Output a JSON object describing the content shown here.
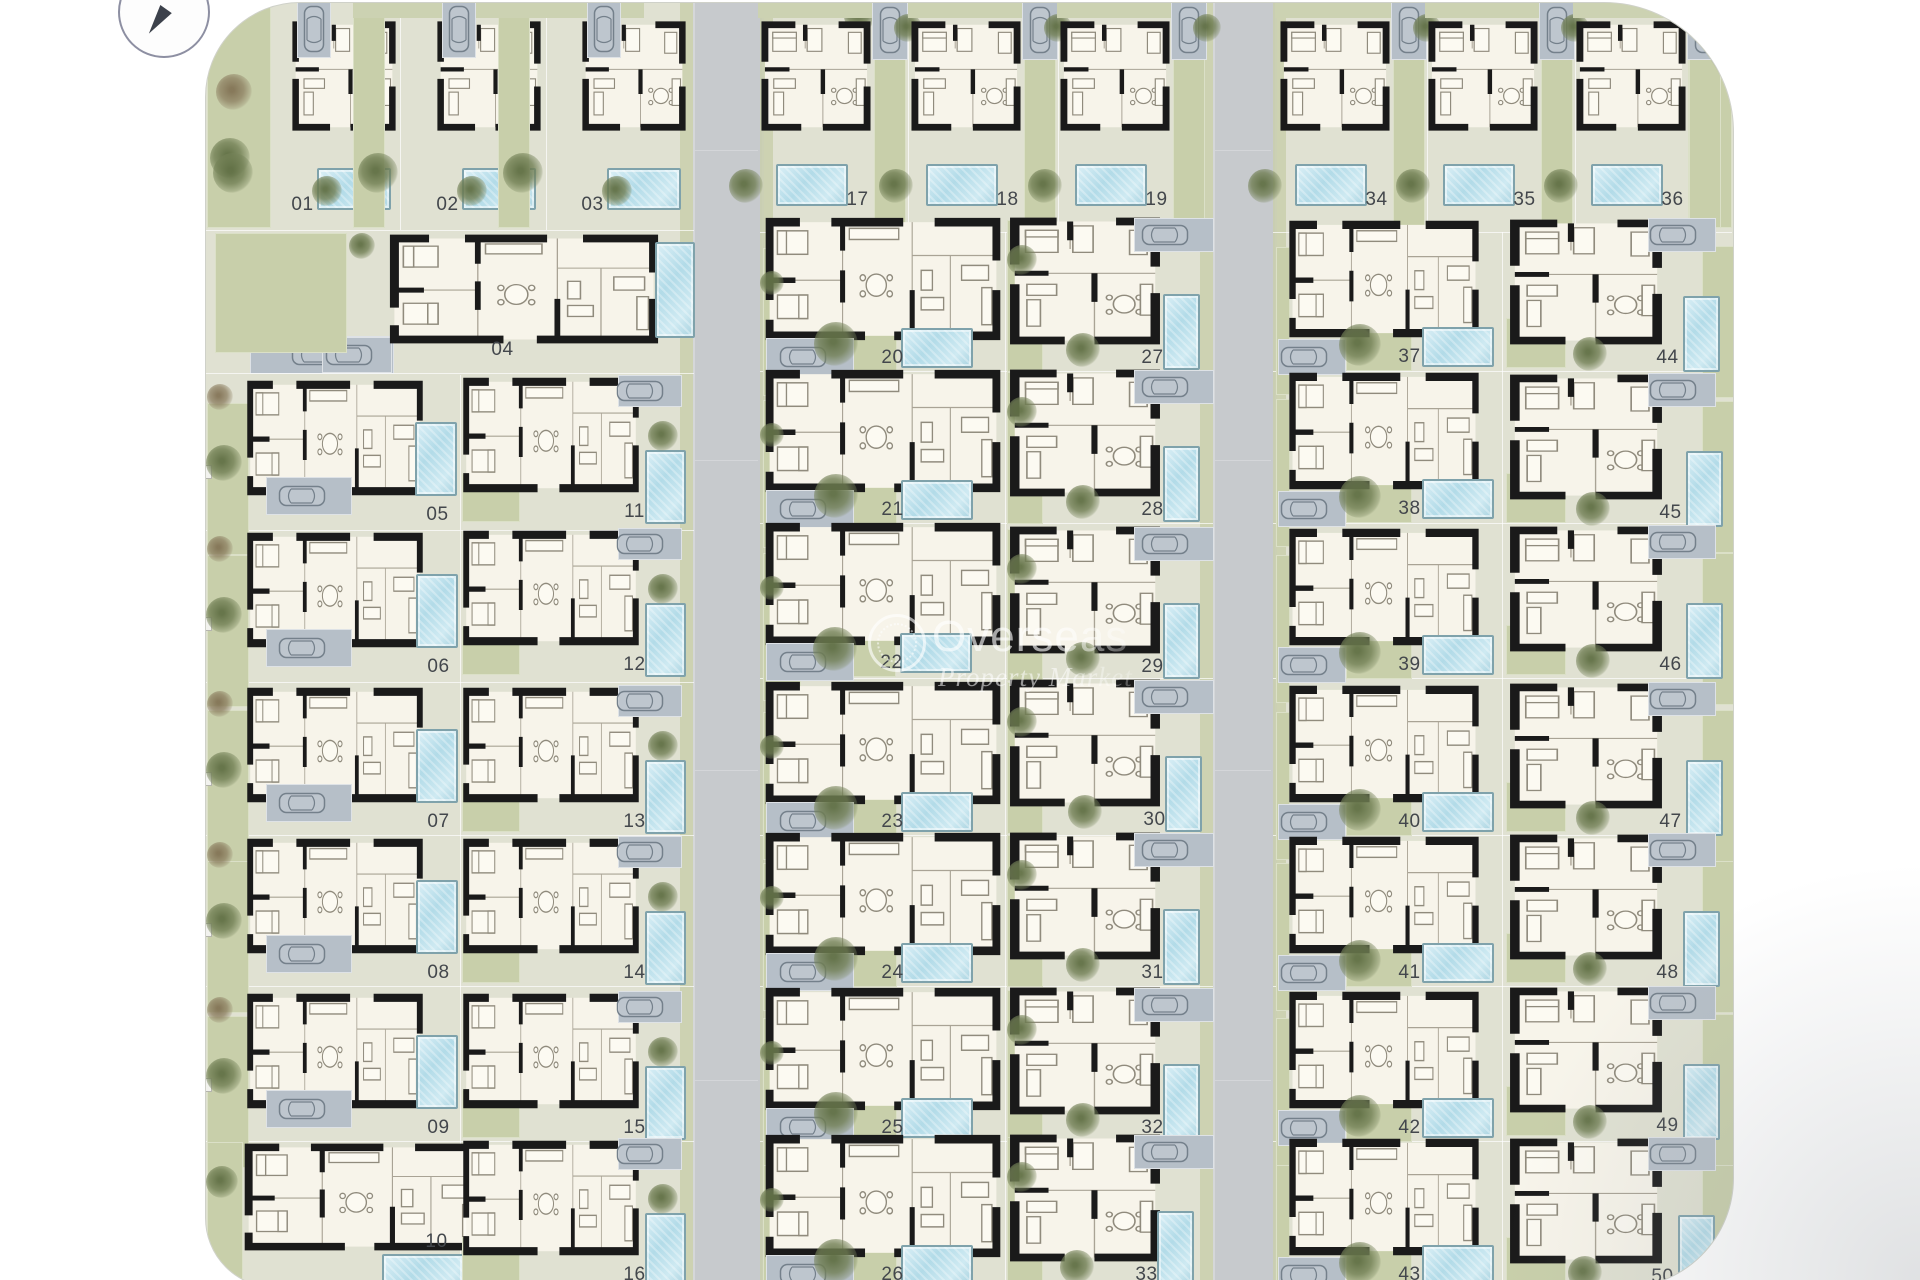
{
  "watermark": {
    "brand": "Overseas",
    "tagline": "Property Market"
  },
  "compass": {
    "icon": "north-arrow"
  },
  "palette": {
    "ground": "#e0e1d2",
    "garden": "#c8cfaa",
    "road": "#c7cacd",
    "parking": "#b6bfc8",
    "pool_water": "#b2dbe8",
    "walls": "#1a1a1a",
    "label_text": "#43474c"
  },
  "plots": [
    {
      "n": "01",
      "kind": "topL",
      "lx": 303,
      "ly": 205
    },
    {
      "n": "02",
      "kind": "topL",
      "lx": 448,
      "ly": 205
    },
    {
      "n": "03",
      "kind": "topL",
      "lx": 593,
      "ly": 205
    },
    {
      "n": "04",
      "kind": "U04",
      "lx": 503,
      "ly": 350
    },
    {
      "n": "05",
      "kind": "LA",
      "lx": 438,
      "ly": 515
    },
    {
      "n": "06",
      "kind": "LA",
      "lx": 439,
      "ly": 667
    },
    {
      "n": "07",
      "kind": "LA",
      "lx": 439,
      "ly": 822
    },
    {
      "n": "08",
      "kind": "LA",
      "lx": 439,
      "ly": 973
    },
    {
      "n": "09",
      "kind": "LA",
      "lx": 439,
      "ly": 1128
    },
    {
      "n": "10",
      "kind": "L10",
      "lx": 437,
      "ly": 1242
    },
    {
      "n": "11",
      "kind": "LB",
      "lx": 635,
      "ly": 512
    },
    {
      "n": "12",
      "kind": "LB",
      "lx": 635,
      "ly": 665
    },
    {
      "n": "13",
      "kind": "LB",
      "lx": 635,
      "ly": 822
    },
    {
      "n": "14",
      "kind": "LB",
      "lx": 635,
      "ly": 973
    },
    {
      "n": "15",
      "kind": "LB",
      "lx": 635,
      "ly": 1128
    },
    {
      "n": "16",
      "kind": "LB",
      "lx": 635,
      "ly": 1275
    },
    {
      "n": "17",
      "kind": "topM",
      "lx": 858,
      "ly": 200
    },
    {
      "n": "18",
      "kind": "topM",
      "lx": 1008,
      "ly": 200
    },
    {
      "n": "19",
      "kind": "topM",
      "lx": 1157,
      "ly": 200
    },
    {
      "n": "20",
      "kind": "MA",
      "lx": 893,
      "ly": 358
    },
    {
      "n": "21",
      "kind": "MA",
      "lx": 893,
      "ly": 510
    },
    {
      "n": "22",
      "kind": "MA",
      "lx": 892,
      "ly": 663
    },
    {
      "n": "23",
      "kind": "MA",
      "lx": 893,
      "ly": 822
    },
    {
      "n": "24",
      "kind": "MA",
      "lx": 893,
      "ly": 973
    },
    {
      "n": "25",
      "kind": "MA",
      "lx": 893,
      "ly": 1128
    },
    {
      "n": "26",
      "kind": "MA",
      "lx": 893,
      "ly": 1275
    },
    {
      "n": "27",
      "kind": "MB",
      "lx": 1153,
      "ly": 358
    },
    {
      "n": "28",
      "kind": "MB",
      "lx": 1153,
      "ly": 510
    },
    {
      "n": "29",
      "kind": "MB",
      "lx": 1153,
      "ly": 667
    },
    {
      "n": "30",
      "kind": "MB",
      "lx": 1155,
      "ly": 820
    },
    {
      "n": "31",
      "kind": "MB",
      "lx": 1153,
      "ly": 973
    },
    {
      "n": "32",
      "kind": "MB",
      "lx": 1153,
      "ly": 1128
    },
    {
      "n": "33",
      "kind": "MB",
      "lx": 1147,
      "ly": 1275
    },
    {
      "n": "34",
      "kind": "topM",
      "lx": 1377,
      "ly": 200
    },
    {
      "n": "35",
      "kind": "topM",
      "lx": 1525,
      "ly": 200
    },
    {
      "n": "36",
      "kind": "topM",
      "lx": 1673,
      "ly": 200
    },
    {
      "n": "37",
      "kind": "RA",
      "lx": 1410,
      "ly": 357
    },
    {
      "n": "38",
      "kind": "RA",
      "lx": 1410,
      "ly": 509
    },
    {
      "n": "39",
      "kind": "RA",
      "lx": 1410,
      "ly": 665
    },
    {
      "n": "40",
      "kind": "RA",
      "lx": 1410,
      "ly": 822
    },
    {
      "n": "41",
      "kind": "RA",
      "lx": 1410,
      "ly": 973
    },
    {
      "n": "42",
      "kind": "RA",
      "lx": 1410,
      "ly": 1128
    },
    {
      "n": "43",
      "kind": "RA",
      "lx": 1410,
      "ly": 1275
    },
    {
      "n": "44",
      "kind": "RB",
      "lx": 1668,
      "ly": 358
    },
    {
      "n": "45",
      "kind": "RB",
      "lx": 1671,
      "ly": 513
    },
    {
      "n": "46",
      "kind": "RB",
      "lx": 1671,
      "ly": 665
    },
    {
      "n": "47",
      "kind": "RB",
      "lx": 1671,
      "ly": 822
    },
    {
      "n": "48",
      "kind": "RB",
      "lx": 1668,
      "ly": 973
    },
    {
      "n": "49",
      "kind": "RB",
      "lx": 1668,
      "ly": 1126
    },
    {
      "n": "50",
      "kind": "RB",
      "lx": 1663,
      "ly": 1277
    }
  ]
}
